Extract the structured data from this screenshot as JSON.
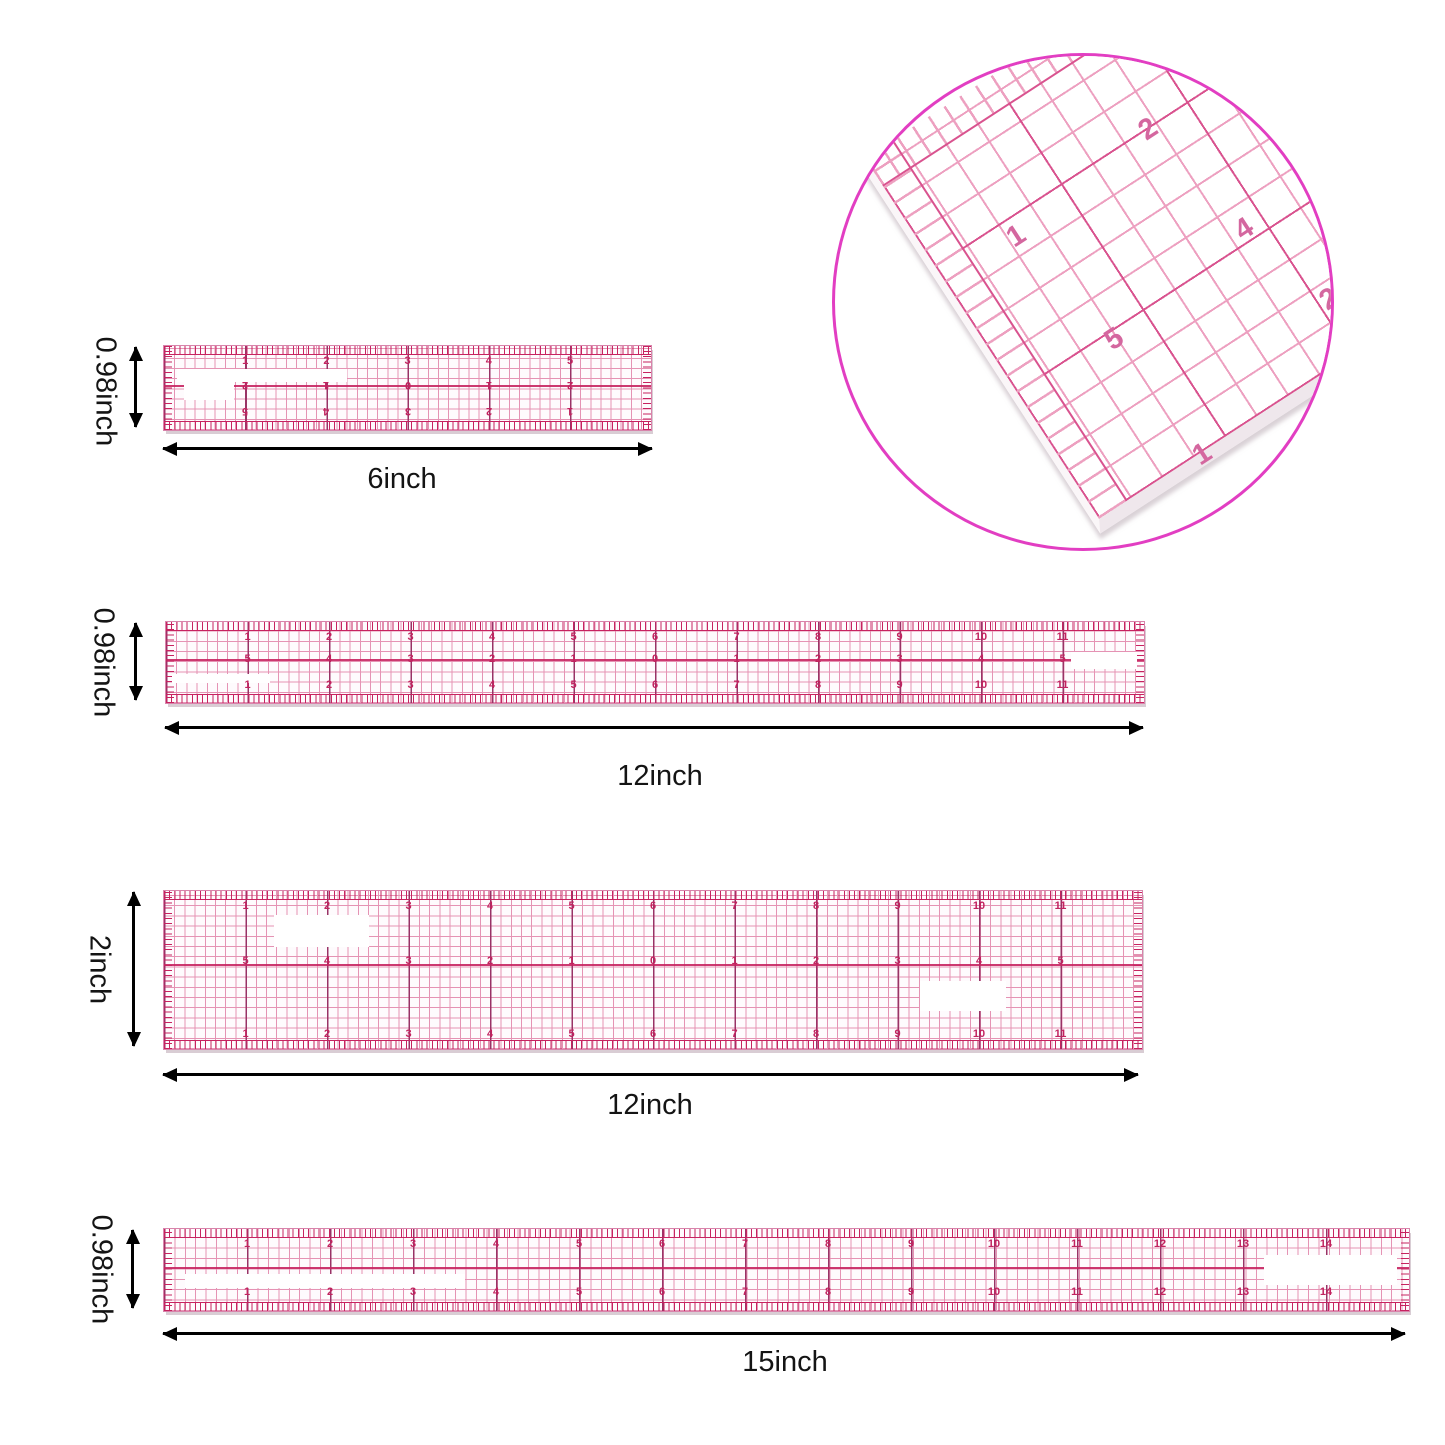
{
  "page": {
    "background": "#ffffff"
  },
  "colors": {
    "grid_pink": "#e593b4",
    "inch_line": "#993366",
    "crimson": "#c72360",
    "digit": "#c2235f",
    "label": "#141414",
    "circle_border": "#e23ec2",
    "inset_grid": "#eda0c0",
    "inset_inch": "#d9538f",
    "inset_digit": "#d4679f"
  },
  "inset": {
    "numbers": [
      {
        "label": "2",
        "x": 305,
        "y": 58
      },
      {
        "label": "1",
        "x": 173,
        "y": 165
      },
      {
        "label": "4",
        "x": 401,
        "y": 158
      },
      {
        "label": "5",
        "x": 271,
        "y": 268
      },
      {
        "label": "1",
        "x": 359,
        "y": 383
      },
      {
        "label": "2",
        "x": 486,
        "y": 228
      }
    ]
  },
  "rulers": [
    {
      "name": "6-inch ruler",
      "width_label": "6inch",
      "height_label": "0.98inch",
      "length_inches": 6,
      "rows": {
        "top": [
          "1",
          "2",
          "3",
          "4",
          "5"
        ],
        "middle": [
          "2",
          "1",
          "0",
          "1",
          "2"
        ],
        "bottom": [
          "5",
          "4",
          "3",
          "2",
          "1"
        ]
      },
      "middle_inverted": true,
      "bottom_inverted": true
    },
    {
      "name": "12-inch narrow ruler",
      "width_label": "12inch",
      "height_label": "0.98inch",
      "length_inches": 12,
      "rows": {
        "top": [
          "1",
          "2",
          "3",
          "4",
          "5",
          "6",
          "7",
          "8",
          "9",
          "10",
          "11"
        ],
        "middle": [
          "5",
          "4",
          "3",
          "2",
          "1",
          "0",
          "1",
          "2",
          "3",
          "4",
          "5"
        ],
        "bottom": [
          "1",
          "2",
          "3",
          "4",
          "5",
          "6",
          "7",
          "8",
          "9",
          "10",
          "11"
        ]
      }
    },
    {
      "name": "12-inch wide ruler",
      "width_label": "12inch",
      "height_label": "2inch",
      "length_inches": 12,
      "rows": {
        "top": [
          "1",
          "2",
          "3",
          "4",
          "5",
          "6",
          "7",
          "8",
          "9",
          "10",
          "11"
        ],
        "middle": [
          "5",
          "4",
          "3",
          "2",
          "1",
          "0",
          "1",
          "2",
          "3",
          "4",
          "5"
        ],
        "bottom": [
          "1",
          "2",
          "3",
          "4",
          "5",
          "6",
          "7",
          "8",
          "9",
          "10",
          "11"
        ]
      }
    },
    {
      "name": "15-inch ruler",
      "width_label": "15inch",
      "height_label": "0.98inch",
      "length_inches": 15,
      "rows": {
        "top": [
          "1",
          "2",
          "3",
          "4",
          "5",
          "6",
          "7",
          "8",
          "9",
          "10",
          "11",
          "12",
          "13",
          "14"
        ],
        "bottom": [
          "1",
          "2",
          "3",
          "4",
          "5",
          "6",
          "7",
          "8",
          "9",
          "10",
          "11",
          "12",
          "13",
          "14"
        ]
      }
    }
  ]
}
